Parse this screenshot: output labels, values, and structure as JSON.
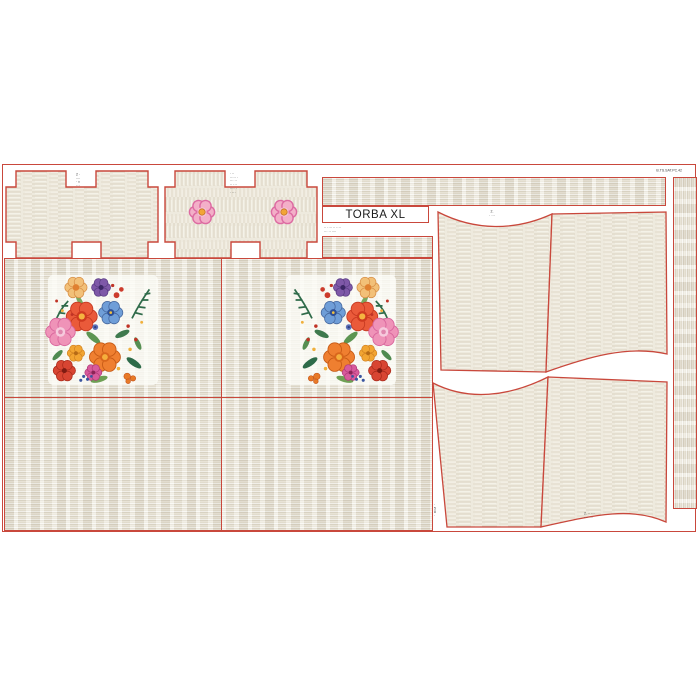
{
  "page": {
    "background": "#ffffff"
  },
  "panel": {
    "name": "TORBA XL bag sewing pattern fabric panel",
    "title": "TORBA XL",
    "title_sub_lines": [
      "·· ···· ·· ····",
      "··· ·· ····"
    ],
    "top_right_code": "B.TS.SAT.PC.42",
    "outline_color": "#c9483c",
    "fabric_base_color": "#eeeade",
    "print_colors": {
      "pink": "#ef93b8",
      "coral_red": "#ea5a3a",
      "orange": "#ef7f30",
      "blue": "#6f9ed8",
      "purple": "#7e58a8",
      "leaf_green": "#4f8a50",
      "dark_green": "#2f6b4a",
      "yellow": "#f2b23c"
    }
  },
  "micro_labels": {
    "gusset_plain": [
      "2 ·",
      "····",
      "· ×",
      "···"
    ],
    "gusset_flowers": [
      "· ··",
      "····· ·",
      "··· ··",
      "·· ···",
      "···· ·",
      "· ···"
    ],
    "front_piece_mark": [
      "2.",
      "· ···"
    ],
    "bottom_right_note": [
      "2. ·· ···",
      "· ·· ···"
    ],
    "left_edge_column": [
      "·",
      "5",
      "8",
      "·"
    ]
  },
  "pieces": [
    {
      "id": "side-gusset-plain",
      "grain": "horizontal",
      "print": "plain texture"
    },
    {
      "id": "side-gusset-flowers",
      "grain": "vertical",
      "print": "two small pink flowers"
    },
    {
      "id": "top-strip",
      "grain": "horizontal",
      "print": "plain texture"
    },
    {
      "id": "small-strip",
      "grain": "horizontal",
      "print": "plain texture"
    },
    {
      "id": "front-panel-left",
      "print": "embroidered flower bouquet"
    },
    {
      "id": "front-panel-right",
      "print": "embroidered flower bouquet (mirrored)"
    },
    {
      "id": "back-panel-left",
      "print": "plain texture"
    },
    {
      "id": "back-panel-right",
      "print": "plain texture"
    },
    {
      "id": "body-top-left",
      "print": "plain texture, curved top edge"
    },
    {
      "id": "body-top-right",
      "print": "plain texture, curved bottom edge"
    },
    {
      "id": "body-bottom-left",
      "print": "plain texture, curved top edge"
    },
    {
      "id": "body-bottom-right",
      "print": "plain texture, curved bottom edge"
    },
    {
      "id": "handle-strip",
      "grain": "vertical",
      "print": "plain texture"
    }
  ]
}
